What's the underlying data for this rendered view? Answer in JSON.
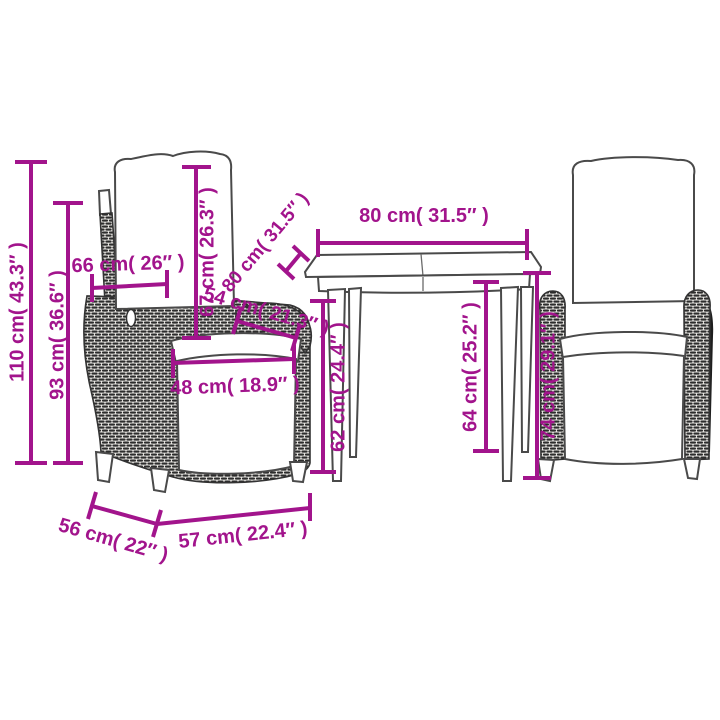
{
  "page": {
    "kind": "product-dimension-diagram",
    "background": "#ffffff"
  },
  "colors": {
    "dimension_annotation": "#A2148C",
    "furniture_outline": "#4a4a4a",
    "rattan_dark": "#2c2c2c"
  },
  "scene": {
    "objects": [
      {
        "name": "reclining-chair-left"
      },
      {
        "name": "garden-table"
      },
      {
        "name": "reclining-chair-right"
      }
    ]
  },
  "dimensions": {
    "chair_total_height": {
      "label": "110 cm( 43.3″ )"
    },
    "chair_back_height": {
      "label": "93 cm( 36.6″ )"
    },
    "chair_back_width": {
      "label": "66 cm( 26″ )"
    },
    "backrest_height": {
      "label": "67 cm( 26.3″ )"
    },
    "armrest_length": {
      "label": "54 cm( 21.3″ )"
    },
    "seat_width": {
      "label": "48 cm( 18.9″ )"
    },
    "table_depth": {
      "label": "80 cm( 31.5″ )"
    },
    "table_width": {
      "label": "80 cm( 31.5″ )"
    },
    "table_clearance": {
      "label": "62 cm( 24.4″ )"
    },
    "table_height": {
      "label": "64 cm( 25.2″ )"
    },
    "armrest_height": {
      "label": "74 cm( 29.1″ )"
    },
    "seat_depth": {
      "label": "56 cm( 22″ )"
    },
    "chair_front_width": {
      "label": "57 cm( 22.4″ )"
    }
  }
}
